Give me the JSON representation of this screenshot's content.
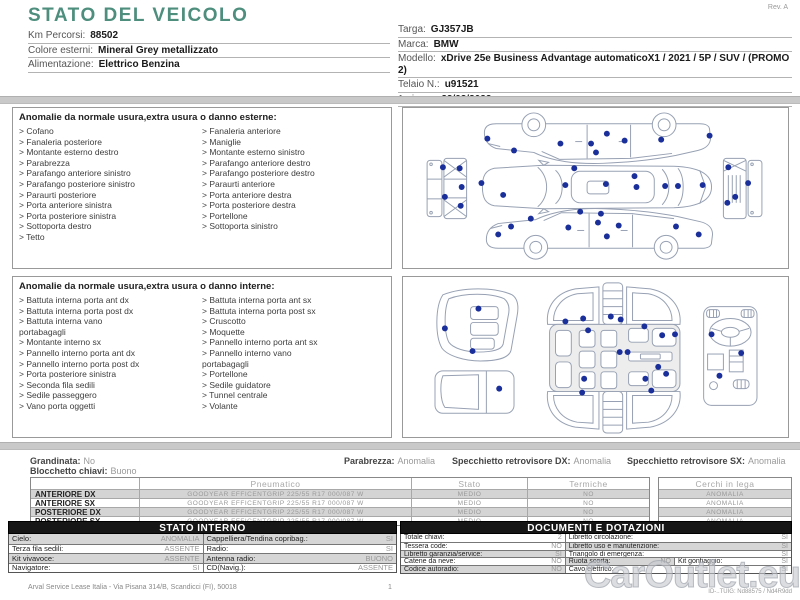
{
  "page": {
    "title": "STATO DEL VEICOLO",
    "rev": "Rev. A",
    "footer_left": "Arval Service Lease Italia - Via Pisana 314/B, Scandicci (FI), 50018",
    "footer_page": "1",
    "footer_right": "ID-..TUIG: Nd88575 / Nd4R9dd",
    "watermark": "CarOutlet.eu"
  },
  "colors": {
    "accent_teal": "#4e8e7d",
    "dot_blue": "#1b2f9b",
    "outline_blue_gray": "#97a1b3",
    "row_shade": "#d4d4d4"
  },
  "vehicle_info_left": [
    {
      "label": "Km Percorsi:",
      "value": "88502"
    },
    {
      "label": "Colore esterni:",
      "value": "Mineral Grey metallizzato"
    },
    {
      "label": "Alimentazione:",
      "value": "Elettrico Benzina"
    }
  ],
  "vehicle_info_right": [
    {
      "label": "Targa:",
      "value": "GJ357JB"
    },
    {
      "label": "Marca:",
      "value": "BMW"
    },
    {
      "label": "Modello:",
      "value": "xDrive 25e Business Advantage automaticoX1 / 2021 / 5P / SUV / (PROMO 2)"
    },
    {
      "label": "Telaio N.:",
      "value": "u91521"
    },
    {
      "label": "1a imm.:",
      "value": "22/02/2022"
    }
  ],
  "exterior_section": {
    "title": "Anomalie da normale usura,extra usura o danno esterne:",
    "bullet": ">",
    "col1": [
      "Cofano",
      "Fanaleria posteriore",
      "Montante esterno destro",
      "Parabrezza",
      "Parafango anteriore sinistro",
      "Parafango posteriore sinistro",
      "Paraurti posteriore",
      "Porta anteriore sinistra",
      "Porta posteriore sinistra",
      "Sottoporta destro",
      "Tetto"
    ],
    "col2": [
      "Fanaleria anteriore",
      "Maniglie",
      "Montante esterno sinistro",
      "Parafango anteriore destro",
      "Parafango posteriore destro",
      "Paraurti anteriore",
      "Porta anteriore destra",
      "Porta posteriore destra",
      "Portellone",
      "Sottoporta sinistro"
    ],
    "dots": [
      [
        83,
        31
      ],
      [
        110,
        43
      ],
      [
        157,
        36
      ],
      [
        188,
        36
      ],
      [
        204,
        26
      ],
      [
        222,
        33
      ],
      [
        193,
        45
      ],
      [
        259,
        32
      ],
      [
        308,
        28
      ],
      [
        77,
        76
      ],
      [
        99,
        88
      ],
      [
        171,
        61
      ],
      [
        162,
        78
      ],
      [
        203,
        77
      ],
      [
        232,
        69
      ],
      [
        234,
        80
      ],
      [
        263,
        79
      ],
      [
        276,
        79
      ],
      [
        301,
        78
      ],
      [
        38,
        60
      ],
      [
        55,
        61
      ],
      [
        40,
        90
      ],
      [
        57,
        80
      ],
      [
        56,
        99
      ],
      [
        327,
        60
      ],
      [
        347,
        76
      ],
      [
        334,
        90
      ],
      [
        326,
        96
      ],
      [
        107,
        120
      ],
      [
        127,
        112
      ],
      [
        94,
        128
      ],
      [
        165,
        121
      ],
      [
        177,
        105
      ],
      [
        195,
        116
      ],
      [
        198,
        107
      ],
      [
        204,
        130
      ],
      [
        216,
        119
      ],
      [
        274,
        120
      ],
      [
        297,
        128
      ]
    ]
  },
  "interior_section": {
    "title": "Anomalie da normale usura,extra usura o danno interne:",
    "bullet": ">",
    "col1": [
      "Battuta interna porta ant dx",
      "Battuta interna porta post dx",
      "Battuta interna vano\nportabagagli",
      "Montante interno sx",
      "Pannello interno porta ant dx",
      "Pannello interno porta post dx",
      "Porta posteriore sinistra",
      "Seconda fila sedili",
      "Sedile passeggero",
      "Vano porta oggetti"
    ],
    "col2": [
      "Battuta interna porta ant sx",
      "Battuta interna porta post sx",
      "Cruscotto",
      "Moquette",
      "Pannello interno porta ant sx",
      "Pannello interno vano\nportabagagli",
      "Portellone",
      "Sedile guidatore",
      "Tunnel centrale",
      "Volante"
    ],
    "dots": [
      [
        74,
        32
      ],
      [
        40,
        52
      ],
      [
        68,
        75
      ],
      [
        95,
        113
      ],
      [
        162,
        45
      ],
      [
        180,
        42
      ],
      [
        208,
        40
      ],
      [
        218,
        43
      ],
      [
        185,
        54
      ],
      [
        242,
        50
      ],
      [
        260,
        59
      ],
      [
        273,
        58
      ],
      [
        217,
        76
      ],
      [
        225,
        76
      ],
      [
        256,
        91
      ],
      [
        264,
        98
      ],
      [
        181,
        103
      ],
      [
        243,
        103
      ],
      [
        179,
        117
      ],
      [
        249,
        115
      ],
      [
        310,
        58
      ],
      [
        340,
        77
      ],
      [
        318,
        100
      ]
    ]
  },
  "status": {
    "grandinata": {
      "label": "Grandinata:",
      "value": "No"
    },
    "blocchetto": {
      "label": "Blocchetto chiavi:",
      "value": "Buono"
    },
    "parabrezza": {
      "label": "Parabrezza:",
      "value": "Anomalia"
    },
    "specchietto_dx": {
      "label": "Specchietto retrovisore DX:",
      "value": "Anomalia"
    },
    "specchietto_sx": {
      "label": "Specchietto retrovisore SX:",
      "value": "Anomalia"
    }
  },
  "tyre_table": {
    "headers": [
      "Pneumatico",
      "Stato",
      "Termiche"
    ],
    "wheels_header": "Cerchi in lega",
    "rows": [
      {
        "position": "ANTERIORE DX",
        "tyre": "GOODYEAR EFFICENTGRIP 225/55 R17 000/087 W",
        "stato": "MEDIO",
        "termiche": "NO",
        "cerchi": "ANOMALIA"
      },
      {
        "position": "ANTERIORE SX",
        "tyre": "GOODYEAR EFFICENTGRIP 225/55 R17 000/087 W",
        "stato": "MEDIO",
        "termiche": "NO",
        "cerchi": "ANOMALIA"
      },
      {
        "position": "POSTERIORE DX",
        "tyre": "GOODYEAR EFFICENTGRIP 225/55 R17 000/087 W",
        "stato": "MEDIO",
        "termiche": "NO",
        "cerchi": "ANOMALIA"
      },
      {
        "position": "POSTERIORE SX",
        "tyre": "GOODYEAR EFFICENTGRIP 225/55 R17 000/087 W",
        "stato": "MEDIO",
        "termiche": "NO",
        "cerchi": "ANOMALIA"
      }
    ]
  },
  "stato_interno": {
    "title": "STATO INTERNO",
    "rows": [
      [
        {
          "label": "Cielo:",
          "value": "ANOMALIA"
        },
        {
          "label": "Cappelliera/Tendina copribag.:",
          "value": "SI"
        }
      ],
      [
        {
          "label": "Terza fila sedili:",
          "value": "ASSENTE"
        },
        {
          "label": "Radio:",
          "value": "SI"
        }
      ],
      [
        {
          "label": "Kit vivavoce:",
          "value": "ASSENTE"
        },
        {
          "label": "Antenna radio:",
          "value": "BUONO"
        }
      ],
      [
        {
          "label": "Navigatore:",
          "value": "SI"
        },
        {
          "label": "CD(Navig.):",
          "value": "ASSENTE"
        }
      ]
    ]
  },
  "documenti": {
    "title": "DOCUMENTI E DOTAZIONI",
    "rows": [
      [
        {
          "label": "Totale chiavi:",
          "value": "2"
        },
        {
          "label": "Libretto circolazione:",
          "value": "SI"
        }
      ],
      [
        {
          "label": "Tessera code:",
          "value": "NO"
        },
        {
          "label": "Libretto uso e manutenzione:",
          "value": "SI"
        }
      ],
      [
        {
          "label": "Libretto garanzia/service:",
          "value": "SI"
        },
        {
          "label": "Triangolo di emergenza:",
          "value": "SI"
        }
      ],
      [
        {
          "label": "Catene da neve:",
          "value": "NO"
        },
        {
          "label": "Ruota scorta:",
          "value": "NO"
        },
        {
          "label": "Kit gonfiaggio:",
          "value": "SI"
        }
      ],
      [
        {
          "label": "Codice autoradio:",
          "value": "NO"
        },
        {
          "label": "Cavo elettrico:",
          "value": "SI"
        }
      ]
    ]
  }
}
